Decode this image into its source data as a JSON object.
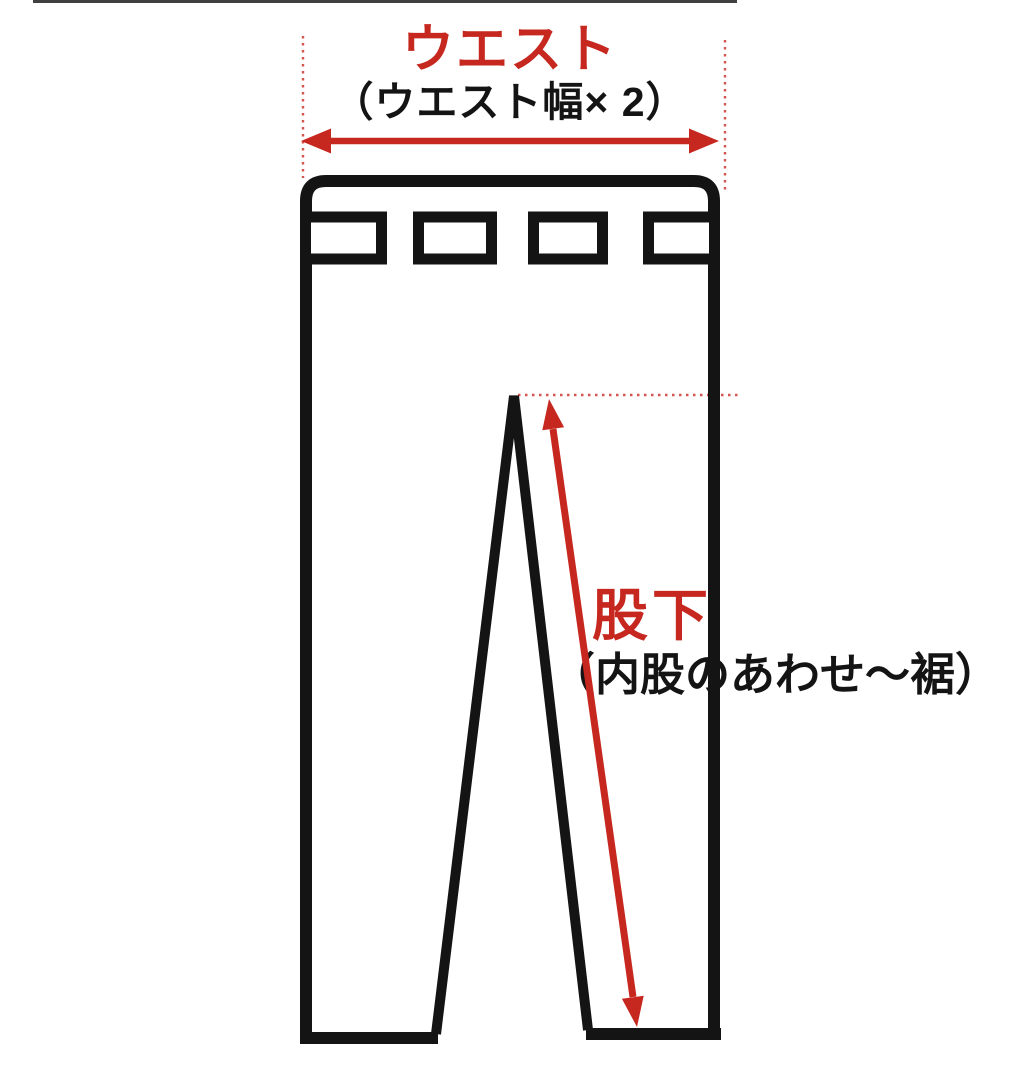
{
  "diagram": {
    "waist": {
      "title": "ウエスト",
      "subtitle": "（ウエスト幅× 2）"
    },
    "inseam": {
      "title": "股下",
      "subtitle": "（内股のあわせ〜裾）"
    }
  },
  "icons": {
    "waist_dimension_arrow": "horizontal-double-arrow",
    "inseam_dimension_arrow": "diagonal-double-arrow",
    "extension_lines": "red-dotted-guides"
  },
  "colors": {
    "accent_red": "#c62820",
    "dotted_red": "#d4544e",
    "line_black": "#141414",
    "background": "#ffffff"
  }
}
